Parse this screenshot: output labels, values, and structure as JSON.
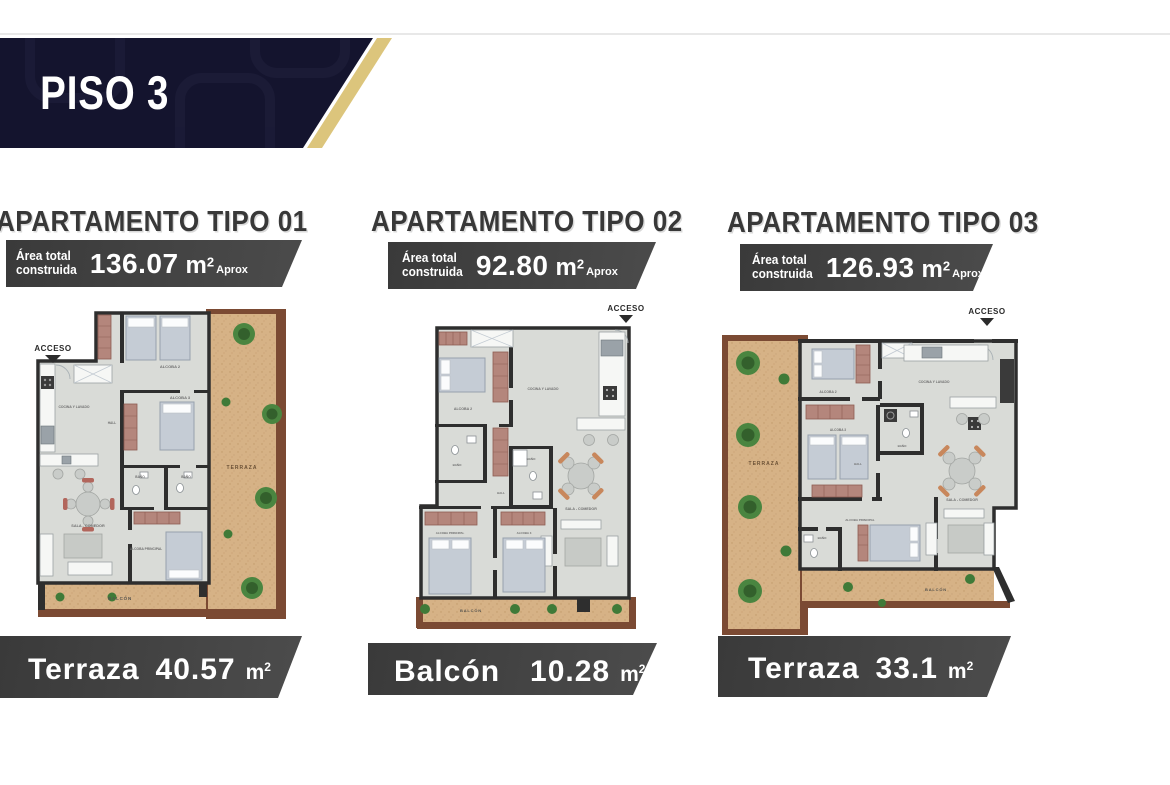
{
  "banner": {
    "title": "PISO 3"
  },
  "shared": {
    "area_label_line1": "Área total",
    "area_label_line2": "construida",
    "unit": "m",
    "unit_exponent": "2",
    "aprox_label": "Aprox"
  },
  "apartments": [
    {
      "title": "APARTAMENTO TIPO 01",
      "area_value": "136.07",
      "outdoor_label": "Terraza",
      "outdoor_value": "40.57",
      "plan": {
        "acceso": "ACCESO",
        "alcoba2": "ALCOBA 2",
        "alcoba3": "ALCOBA 3",
        "cocina": "COCINA Y LAVADO",
        "hall": "HALL",
        "bano": "BAÑO",
        "sala": "SALA - COMEDOR",
        "principal": "ALCOBA PRINCIPAL",
        "terraza": "TERRAZA",
        "balcon": "BALCÓN"
      }
    },
    {
      "title": "APARTAMENTO TIPO 02",
      "area_value": "92.80",
      "outdoor_label": "Balcón",
      "outdoor_value": "10.28",
      "plan": {
        "acceso": "ACCESO",
        "alcoba2": "ALCOBA 2",
        "alcoba3": "ALCOBA 3",
        "cocina": "COCINA Y LAVADO",
        "hall": "HALL",
        "bano": "BAÑO",
        "sala": "SALA - COMEDOR",
        "principal": "ALCOBA PRINCIPAL",
        "balcon": "BALCÓN"
      }
    },
    {
      "title": "APARTAMENTO TIPO 03",
      "area_value": "126.93",
      "outdoor_label": "Terraza",
      "outdoor_value": "33.1",
      "plan": {
        "acceso": "ACCESO",
        "alcoba2": "ALCOBA 2",
        "alcoba3": "ALCOBA 3",
        "cocina": "COCINA Y LAVADO",
        "hall": "HALL",
        "bano": "BAÑO",
        "sala": "SALA - COMEDOR",
        "principal": "ALCOBA PRINCIPAL",
        "terraza": "TERRAZA",
        "balcon": "BALCÓN"
      }
    }
  ],
  "colors": {
    "banner_navy": "#14142e",
    "banner_gold": "#dcc57c",
    "badge_gray": "#424242",
    "heading_gray": "#383838",
    "terraza_sand": "#d6b286",
    "terraza_border": "#7b4a33",
    "floor_gray": "#d9dbd7",
    "wall_dark": "#2e2e2e",
    "tree_green": "#4a8540",
    "closet_rose": "#b4867c",
    "chair_orange": "#c8875c"
  }
}
